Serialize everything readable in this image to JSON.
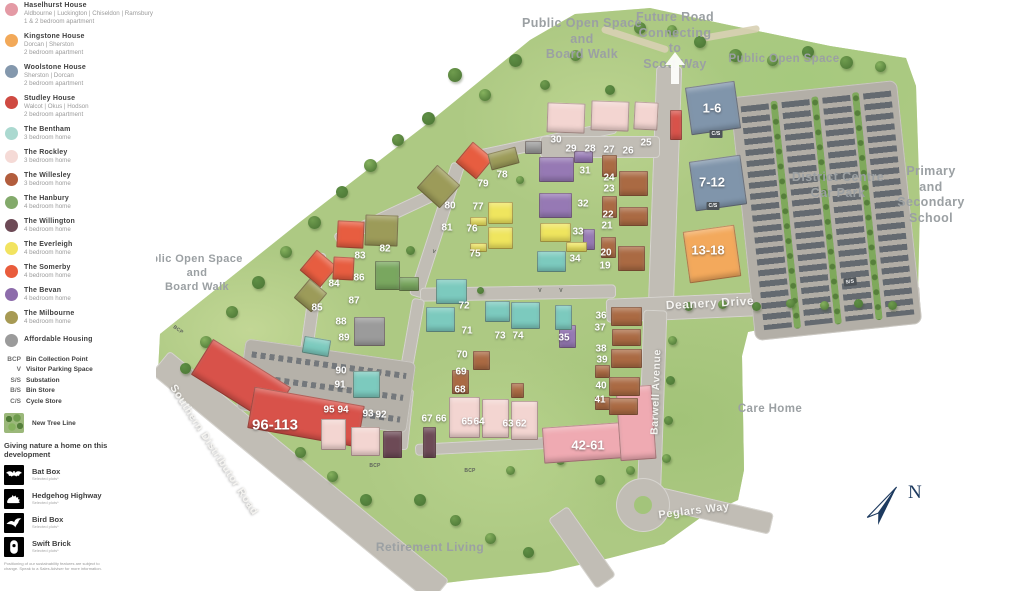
{
  "palette": {
    "terrain": "#adc983",
    "road": "#c1bdb5",
    "carpark": "#b3afa7",
    "label_grey": "#9ba0a3",
    "compass_navy": "#1d3a5f",
    "houses": {
      "haselhurst": "#efaab2",
      "kingstone": "#f3a95c",
      "woolstone": "#8095ab",
      "studley": "#d8524a",
      "bentham": "#7ccabe",
      "rockley": "#f3d5d1",
      "willesley": "#aa6a43",
      "hanbury": "#79a75f",
      "willington": "#6d4a56",
      "everleigh": "#efe55e",
      "somerby": "#e75d40",
      "bevan": "#9679b4",
      "milbourne": "#9c9b59",
      "affordable": "#9b9b9b"
    }
  },
  "legend": {
    "house_types": [
      {
        "name": "Haselhurst House",
        "detail": "Aldbourne | Luckington | Chiseldon | Ramsbury",
        "type": "1 & 2 bedroom apartment",
        "color": "#e49aa5"
      },
      {
        "name": "Kingstone House",
        "detail": "Dorcan | Sherston",
        "type": "2 bedroom apartment",
        "color": "#f2a959"
      },
      {
        "name": "Woolstone House",
        "detail": "Sherston | Dorcan",
        "type": "2 bedroom apartment",
        "color": "#8498ad"
      },
      {
        "name": "Studley House",
        "detail": "Walcot | Okus | Hodson",
        "type": "2 bedroom apartment",
        "color": "#cf4a42"
      },
      {
        "name": "The Bentham",
        "type": "3 bedroom home",
        "color": "#abd9d0"
      },
      {
        "name": "The Rockley",
        "type": "3 bedroom home",
        "color": "#f5dad6"
      },
      {
        "name": "The Willesley",
        "type": "3 bedroom home",
        "color": "#b25d3d"
      },
      {
        "name": "The Hanbury",
        "type": "4 bedroom home",
        "color": "#83aa6b"
      },
      {
        "name": "The Willington",
        "type": "4 bedroom home",
        "color": "#6d4a56"
      },
      {
        "name": "The Everleigh",
        "type": "4 bedroom home",
        "color": "#f2e360"
      },
      {
        "name": "The Somerby",
        "type": "4 bedroom home",
        "color": "#e95c3c"
      },
      {
        "name": "The Bevan",
        "type": "4 bedroom home",
        "color": "#8d6cab"
      },
      {
        "name": "The Milbourne",
        "type": "4 bedroom home",
        "color": "#a79a54"
      }
    ],
    "affordable": {
      "name": "Affordable Housing",
      "color": "#9b9b9b"
    },
    "abbreviations": [
      {
        "code": "BCP",
        "label": "Bin Collection Point"
      },
      {
        "code": "V",
        "label": "Visitor Parking Space"
      },
      {
        "code": "S/S",
        "label": "Substation"
      },
      {
        "code": "B/S",
        "label": "Bin Store"
      },
      {
        "code": "C/S",
        "label": "Cycle Store"
      }
    ],
    "tree_line_label": "New Tree Line",
    "nature": {
      "heading": "Giving nature a home on this development",
      "items": [
        {
          "name": "Bat Box",
          "note": "Selected plots*",
          "icon": "bat-icon"
        },
        {
          "name": "Hedgehog Highway",
          "note": "Selected plots*",
          "icon": "hedgehog-icon"
        },
        {
          "name": "Bird Box",
          "note": "Selected plots*",
          "icon": "bird-icon"
        },
        {
          "name": "Swift Brick",
          "note": "Selected plots*",
          "icon": "swift-icon"
        }
      ],
      "disclaimer": "Positioning of our sustainability features are subject to change. Speak to a Sales Adviser for more information."
    }
  },
  "map": {
    "area_labels": [
      {
        "text": "Public Open Space\nand\nBoard Walk",
        "x": 582,
        "y": 16,
        "size": 12.5
      },
      {
        "text": "Future Road\nConnecting\nto\nScott Way",
        "x": 675,
        "y": 10,
        "size": 12.5
      },
      {
        "text": "Public Open Space",
        "x": 784,
        "y": 52,
        "size": 11.5
      },
      {
        "text": "District Centre\nCar Park",
        "x": 838,
        "y": 170,
        "size": 12.5
      },
      {
        "text": "Primary\nand\nSecondary\nSchool",
        "x": 931,
        "y": 164,
        "size": 12.5
      },
      {
        "text": "Care Home",
        "x": 770,
        "y": 402,
        "size": 11.5
      },
      {
        "text": "Retirement Living",
        "x": 430,
        "y": 540,
        "size": 12
      },
      {
        "text": "blic Open Space\nand\nBoard Walk",
        "x": 197,
        "y": 253,
        "size": 11
      }
    ],
    "road_labels": [
      {
        "text": "Deanery Drive",
        "x": 710,
        "y": 303,
        "rot": -3,
        "size": 12
      },
      {
        "text": "Barwell Avenue",
        "x": 656,
        "y": 392,
        "rot": -88,
        "size": 10.5
      },
      {
        "text": "Peglars Way",
        "x": 694,
        "y": 511,
        "rot": -7,
        "size": 11
      },
      {
        "text": "Southern Distributor Road",
        "x": 214,
        "y": 450,
        "rot": 57,
        "size": 11
      }
    ],
    "plots": [
      {
        "t": "1-6",
        "x": 712,
        "y": 108,
        "s": 13
      },
      {
        "t": "7-12",
        "x": 712,
        "y": 182,
        "s": 13
      },
      {
        "t": "13-18",
        "x": 708,
        "y": 250,
        "s": 13
      },
      {
        "t": "42-61",
        "x": 588,
        "y": 445,
        "s": 13
      },
      {
        "t": "96-113",
        "x": 275,
        "y": 425,
        "s": 15
      },
      {
        "t": "30",
        "x": 556,
        "y": 140
      },
      {
        "t": "29",
        "x": 571,
        "y": 149
      },
      {
        "t": "28",
        "x": 590,
        "y": 149
      },
      {
        "t": "27",
        "x": 609,
        "y": 150
      },
      {
        "t": "26",
        "x": 628,
        "y": 151
      },
      {
        "t": "25",
        "x": 646,
        "y": 143
      },
      {
        "t": "31",
        "x": 585,
        "y": 171
      },
      {
        "t": "24",
        "x": 609,
        "y": 178
      },
      {
        "t": "23",
        "x": 609,
        "y": 189
      },
      {
        "t": "32",
        "x": 583,
        "y": 204
      },
      {
        "t": "22",
        "x": 608,
        "y": 215
      },
      {
        "t": "21",
        "x": 607,
        "y": 226
      },
      {
        "t": "33",
        "x": 578,
        "y": 232
      },
      {
        "t": "20",
        "x": 606,
        "y": 253
      },
      {
        "t": "19",
        "x": 605,
        "y": 266
      },
      {
        "t": "34",
        "x": 575,
        "y": 259
      },
      {
        "t": "36",
        "x": 601,
        "y": 316
      },
      {
        "t": "37",
        "x": 600,
        "y": 328
      },
      {
        "t": "35",
        "x": 564,
        "y": 338
      },
      {
        "t": "38",
        "x": 601,
        "y": 349
      },
      {
        "t": "39",
        "x": 602,
        "y": 360
      },
      {
        "t": "40",
        "x": 601,
        "y": 386
      },
      {
        "t": "41",
        "x": 600,
        "y": 400
      },
      {
        "t": "62",
        "x": 521,
        "y": 424
      },
      {
        "t": "63",
        "x": 508,
        "y": 424
      },
      {
        "t": "64",
        "x": 479,
        "y": 422
      },
      {
        "t": "65",
        "x": 467,
        "y": 422
      },
      {
        "t": "66",
        "x": 441,
        "y": 419
      },
      {
        "t": "67",
        "x": 427,
        "y": 419
      },
      {
        "t": "68",
        "x": 460,
        "y": 390
      },
      {
        "t": "69",
        "x": 461,
        "y": 372
      },
      {
        "t": "70",
        "x": 462,
        "y": 355
      },
      {
        "t": "71",
        "x": 467,
        "y": 331
      },
      {
        "t": "72",
        "x": 464,
        "y": 306
      },
      {
        "t": "73",
        "x": 500,
        "y": 336
      },
      {
        "t": "74",
        "x": 518,
        "y": 336
      },
      {
        "t": "75",
        "x": 475,
        "y": 254
      },
      {
        "t": "76",
        "x": 472,
        "y": 229
      },
      {
        "t": "77",
        "x": 478,
        "y": 207
      },
      {
        "t": "78",
        "x": 502,
        "y": 175
      },
      {
        "t": "79",
        "x": 483,
        "y": 184
      },
      {
        "t": "80",
        "x": 450,
        "y": 206
      },
      {
        "t": "81",
        "x": 447,
        "y": 228
      },
      {
        "t": "82",
        "x": 385,
        "y": 249
      },
      {
        "t": "83",
        "x": 360,
        "y": 256
      },
      {
        "t": "84",
        "x": 334,
        "y": 284
      },
      {
        "t": "85",
        "x": 317,
        "y": 308
      },
      {
        "t": "86",
        "x": 359,
        "y": 278
      },
      {
        "t": "87",
        "x": 354,
        "y": 301
      },
      {
        "t": "88",
        "x": 341,
        "y": 322
      },
      {
        "t": "89",
        "x": 344,
        "y": 338
      },
      {
        "t": "90",
        "x": 341,
        "y": 371
      },
      {
        "t": "91",
        "x": 340,
        "y": 385
      },
      {
        "t": "92",
        "x": 381,
        "y": 415
      },
      {
        "t": "93",
        "x": 368,
        "y": 414
      },
      {
        "t": "94",
        "x": 343,
        "y": 410
      },
      {
        "t": "95",
        "x": 329,
        "y": 410
      }
    ],
    "markers": [
      {
        "t": "BCP",
        "x": 178,
        "y": 330,
        "rot": 35
      },
      {
        "t": "BCP",
        "x": 375,
        "y": 466,
        "rot": 0
      },
      {
        "t": "BCP",
        "x": 470,
        "y": 471,
        "rot": 0
      },
      {
        "t": "V",
        "x": 540,
        "y": 291,
        "rot": 0
      },
      {
        "t": "V",
        "x": 561,
        "y": 291,
        "rot": 0
      },
      {
        "t": "V",
        "x": 434,
        "y": 252,
        "rot": 15
      },
      {
        "t": "S/S",
        "x": 850,
        "y": 282,
        "rot": -6,
        "box": true
      },
      {
        "t": "C/S",
        "x": 716,
        "y": 134,
        "rot": 0,
        "box": true
      },
      {
        "t": "C/S",
        "x": 713,
        "y": 206,
        "rot": 0,
        "box": true
      }
    ],
    "buildings": [
      [
        "woolstone",
        688,
        84,
        50,
        48,
        -8
      ],
      [
        "woolstone",
        692,
        158,
        52,
        50,
        -8
      ],
      [
        "kingstone",
        686,
        228,
        52,
        52,
        -8
      ],
      [
        "haselhurst",
        543,
        424,
        106,
        36,
        -4
      ],
      [
        "haselhurst",
        618,
        386,
        36,
        74,
        -4
      ],
      [
        "studley",
        195,
        360,
        92,
        42,
        32
      ],
      [
        "studley",
        250,
        396,
        112,
        42,
        10
      ],
      [
        "studley",
        670,
        110,
        12,
        30,
        0
      ],
      [
        "rockley",
        547,
        103,
        38,
        30,
        2
      ],
      [
        "rockley",
        591,
        101,
        38,
        30,
        2
      ],
      [
        "rockley",
        634,
        102,
        24,
        28,
        3
      ],
      [
        "bevan",
        539,
        157,
        35,
        25,
        0
      ],
      [
        "bevan",
        574,
        151,
        19,
        12,
        0
      ],
      [
        "bevan",
        539,
        193,
        33,
        25,
        0
      ],
      [
        "bevan",
        583,
        229,
        12,
        21,
        0
      ],
      [
        "bevan",
        559,
        325,
        17,
        23,
        0
      ],
      [
        "everleigh",
        540,
        223,
        31,
        19,
        0
      ],
      [
        "everleigh",
        566,
        242,
        21,
        10,
        0
      ],
      [
        "everleigh",
        488,
        202,
        25,
        22,
        0
      ],
      [
        "everleigh",
        488,
        227,
        25,
        22,
        0
      ],
      [
        "everleigh",
        470,
        217,
        17,
        9,
        0
      ],
      [
        "everleigh",
        470,
        243,
        17,
        9,
        0
      ],
      [
        "bentham",
        537,
        251,
        29,
        21,
        0
      ],
      [
        "bentham",
        555,
        305,
        17,
        25,
        0
      ],
      [
        "bentham",
        436,
        279,
        31,
        25,
        0
      ],
      [
        "bentham",
        485,
        301,
        25,
        21,
        0
      ],
      [
        "bentham",
        511,
        302,
        29,
        27,
        0
      ],
      [
        "bentham",
        426,
        307,
        29,
        25,
        0
      ],
      [
        "bentham",
        353,
        371,
        27,
        27,
        0
      ],
      [
        "bentham",
        303,
        338,
        27,
        17,
        10
      ],
      [
        "hanbury",
        375,
        261,
        25,
        29,
        0
      ],
      [
        "hanbury",
        399,
        277,
        20,
        14,
        0
      ],
      [
        "willesley",
        602,
        155,
        15,
        22,
        0
      ],
      [
        "willesley",
        619,
        171,
        29,
        25,
        0
      ],
      [
        "willesley",
        602,
        196,
        15,
        22,
        0
      ],
      [
        "willesley",
        619,
        207,
        29,
        19,
        0
      ],
      [
        "willesley",
        601,
        237,
        15,
        21,
        0
      ],
      [
        "willesley",
        618,
        246,
        27,
        25,
        0
      ],
      [
        "willesley",
        611,
        307,
        31,
        19,
        0
      ],
      [
        "willesley",
        612,
        329,
        29,
        17,
        0
      ],
      [
        "willesley",
        611,
        349,
        31,
        19,
        0
      ],
      [
        "willesley",
        595,
        365,
        15,
        13,
        0
      ],
      [
        "willesley",
        609,
        377,
        31,
        19,
        0
      ],
      [
        "willesley",
        595,
        397,
        15,
        13,
        0
      ],
      [
        "willesley",
        609,
        398,
        29,
        17,
        0
      ],
      [
        "willesley",
        452,
        370,
        17,
        24,
        0
      ],
      [
        "willesley",
        473,
        351,
        17,
        19,
        0
      ],
      [
        "willesley",
        511,
        383,
        13,
        15,
        0
      ],
      [
        "rockley",
        449,
        397,
        31,
        41,
        0
      ],
      [
        "rockley",
        482,
        399,
        27,
        39,
        0
      ],
      [
        "rockley",
        511,
        401,
        27,
        39,
        0
      ],
      [
        "willington",
        423,
        427,
        13,
        31,
        0
      ],
      [
        "willington",
        383,
        431,
        19,
        27,
        0
      ],
      [
        "rockley",
        351,
        427,
        29,
        29,
        0
      ],
      [
        "rockley",
        321,
        419,
        25,
        31,
        0
      ],
      [
        "somerby",
        461,
        147,
        27,
        27,
        40
      ],
      [
        "somerby",
        337,
        221,
        27,
        27,
        3
      ],
      [
        "somerby",
        305,
        255,
        27,
        27,
        40
      ],
      [
        "somerby",
        333,
        257,
        21,
        23,
        3
      ],
      [
        "milbourne",
        423,
        171,
        31,
        31,
        42
      ],
      [
        "milbourne",
        489,
        150,
        29,
        17,
        -15
      ],
      [
        "milbourne",
        365,
        215,
        33,
        31,
        2
      ],
      [
        "milbourne",
        299,
        283,
        23,
        25,
        40
      ],
      [
        "affordable",
        354,
        317,
        31,
        29,
        0
      ],
      [
        "affordable",
        525,
        141,
        17,
        13,
        0
      ]
    ],
    "compass_letter": "N"
  }
}
